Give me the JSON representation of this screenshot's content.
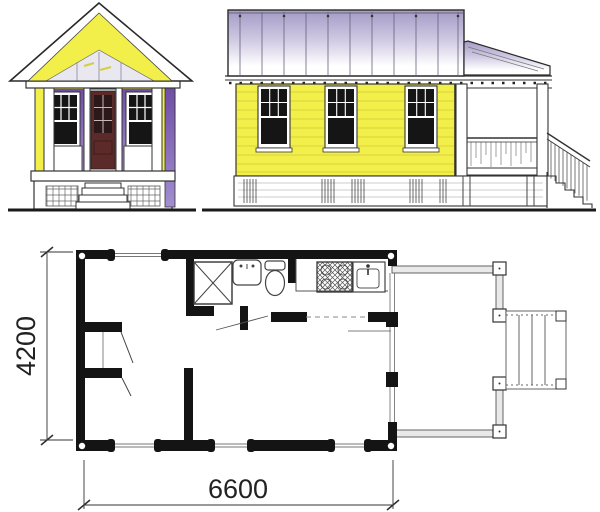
{
  "floor_plan": {
    "depth_dimension": "4200",
    "width_dimension": "6600"
  },
  "colors": {
    "paper": "#ffffff",
    "siding_yellow": "#f2ee4a",
    "porch_purple_dark": "#6f4da6",
    "porch_purple_light": "#a28ed0",
    "metal_roof_purple": "#a49ac6",
    "metal_roof_fade": "#ffffff",
    "door_brown": "#5c2b29",
    "window_pane": "#151515",
    "plan_wall": "#141414",
    "deck_rail": "#e9e9e9",
    "ink": "#222222"
  }
}
